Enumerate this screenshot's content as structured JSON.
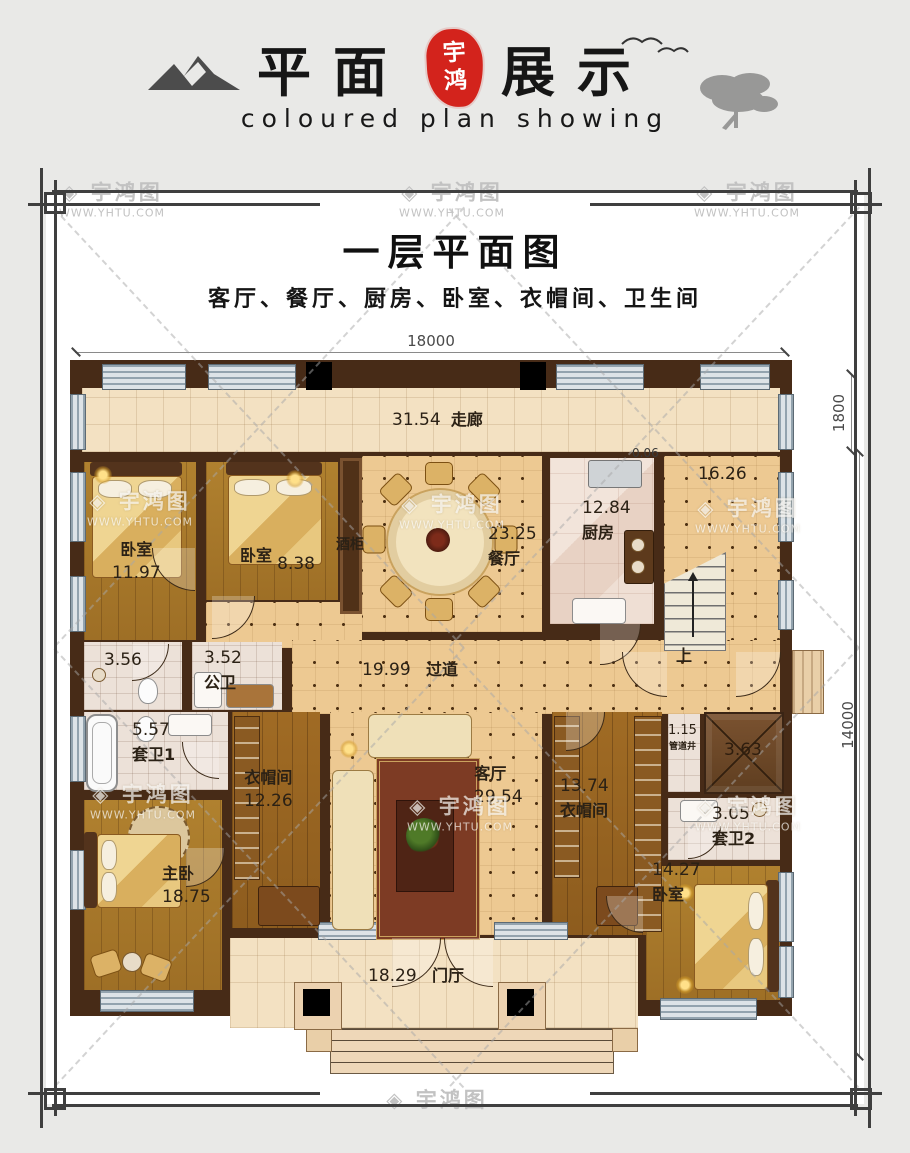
{
  "header": {
    "title_left": "平面",
    "title_right": "展示",
    "seal_char1": "宇",
    "seal_char2": "鸿",
    "subtitle": "coloured plan showing"
  },
  "watermark": {
    "logo_glyph": "◈",
    "brand": "宇鸿图",
    "url": "WWW.YHTU.COM"
  },
  "plan": {
    "title": "一层平面图",
    "room_list": "客厅、餐厅、厨房、卧室、衣帽间、卫生间",
    "dims": {
      "width_top": "18000",
      "corridor_right": "1800",
      "height_right": "14000"
    },
    "rooms": {
      "corridor": {
        "area": "31.54",
        "name": "走廊"
      },
      "bedroom_tl": {
        "name": "卧室",
        "area": "11.97"
      },
      "bedroom_tm": {
        "name": "卧室",
        "area": "8.38"
      },
      "wine_cabinet": {
        "name": "酒柜"
      },
      "dining": {
        "area": "23.25",
        "name": "餐厅"
      },
      "kitchen": {
        "area": "12.84",
        "name": "厨房"
      },
      "stair_hall": {
        "area": "16.26"
      },
      "wall_dim": {
        "area": "0.06"
      },
      "wc": {
        "area": "3.56"
      },
      "public_bath": {
        "area": "3.52",
        "name": "公卫"
      },
      "ensuite1": {
        "area": "5.57",
        "name": "套卫1"
      },
      "hallway": {
        "area": "19.99",
        "name": "过道"
      },
      "cloakroom_l": {
        "name": "衣帽间",
        "area": "12.26"
      },
      "living": {
        "name": "客厅",
        "area": "29.54"
      },
      "cloakroom_r": {
        "area": "13.74",
        "name": "衣帽间"
      },
      "pipe_shaft": {
        "area": "1.15",
        "name": "管道井"
      },
      "shaft": {
        "area": "3.63"
      },
      "ensuite2": {
        "area": "3.05",
        "name": "套卫2"
      },
      "master": {
        "name": "主卧",
        "area": "18.75"
      },
      "bedroom_br": {
        "area": "14.27",
        "name": "卧室"
      },
      "foyer": {
        "area": "18.29",
        "name": "门厅"
      },
      "stairs_up_label": "上"
    },
    "colors": {
      "seal_red": "#d3231c",
      "wall_brown": "#472b17",
      "wood_floor": "#a9782c",
      "tile_beige": "#edc992",
      "frame_gray": "#3f3f3f"
    }
  }
}
